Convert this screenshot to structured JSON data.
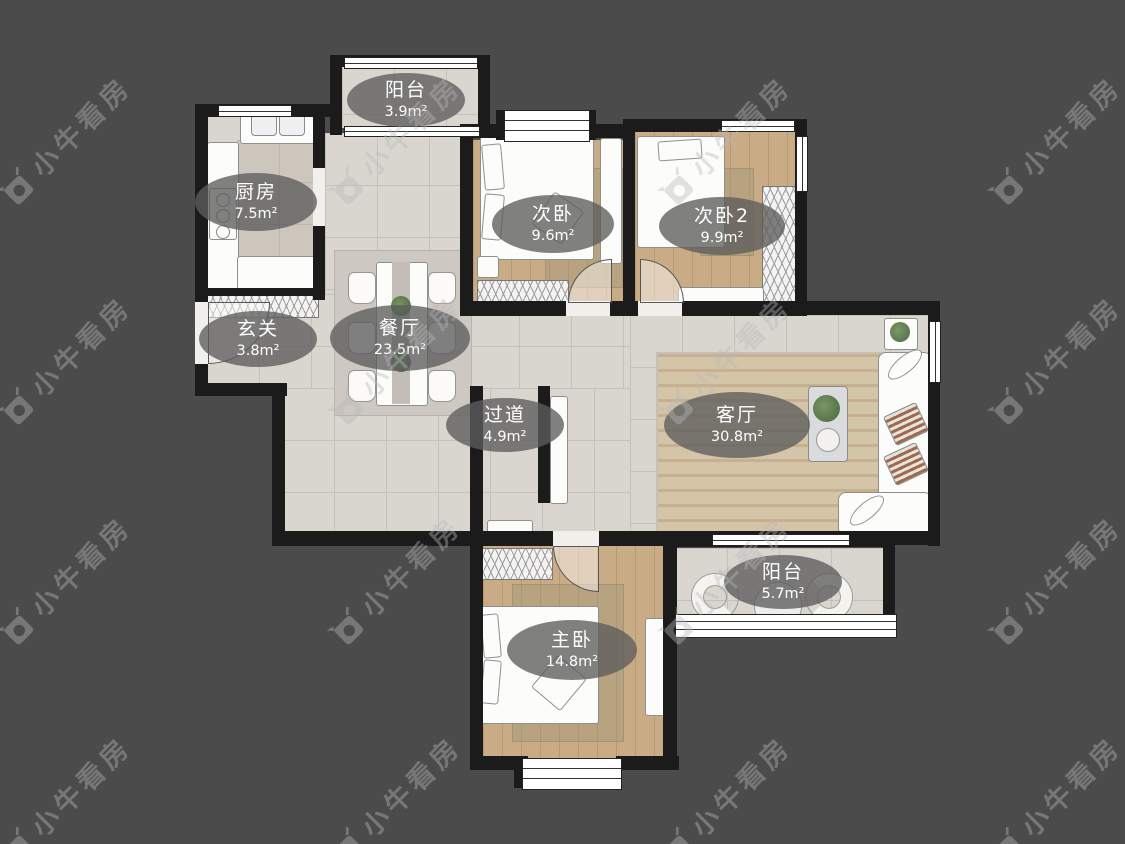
{
  "watermark": {
    "text": "小牛看房",
    "logo": "bull-camera-icon"
  },
  "palette": {
    "background": "#4b4b4b",
    "walls": "#1b1b1b",
    "tile_floor": "#d9d5cf",
    "wood_floor": "#c9ab85",
    "label_bg": "rgba(92,92,92,0.78)",
    "label_text": "#ffffff"
  },
  "rooms": [
    {
      "id": "balcony-top",
      "name": "阳台",
      "area": "3.9m²"
    },
    {
      "id": "kitchen",
      "name": "厨房",
      "area": "7.5m²"
    },
    {
      "id": "bedroom-2",
      "name": "次卧",
      "area": "9.6m²"
    },
    {
      "id": "bedroom-3",
      "name": "次卧2",
      "area": "9.9m²"
    },
    {
      "id": "entry",
      "name": "玄关",
      "area": "3.8m²"
    },
    {
      "id": "dining",
      "name": "餐厅",
      "area": "23.5m²"
    },
    {
      "id": "hallway",
      "name": "过道",
      "area": "4.9m²"
    },
    {
      "id": "living",
      "name": "客厅",
      "area": "30.8m²"
    },
    {
      "id": "balcony-bottom",
      "name": "阳台",
      "area": "5.7m²"
    },
    {
      "id": "master-bedroom",
      "name": "主卧",
      "area": "14.8m²"
    }
  ]
}
